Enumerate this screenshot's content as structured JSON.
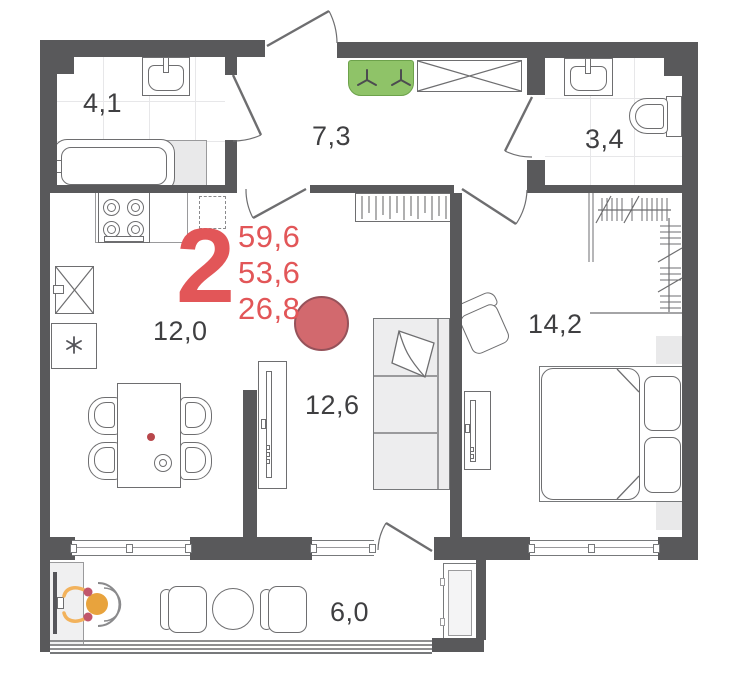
{
  "apartment": {
    "rooms_count": "2",
    "stats": {
      "total": "59,6",
      "living": "53,6",
      "kitchen": "26,8"
    },
    "rooms": {
      "bathroom": "4,1",
      "hallway": "7,3",
      "wc": "3,4",
      "kitchen": "12,0",
      "living": "12,6",
      "bedroom": "14,2",
      "balcony": "6,0"
    },
    "colors": {
      "wall": "#59595b",
      "line": "#6e6e70",
      "accent_red": "#e25658",
      "marker_fill": "#d2696e",
      "marker_border": "#96525a",
      "cabinet_green": "#8fc368",
      "person_orange": "#e8a33d",
      "person_shoulder_red": "#c2566b",
      "table_dot_red": "#b8474b"
    }
  }
}
